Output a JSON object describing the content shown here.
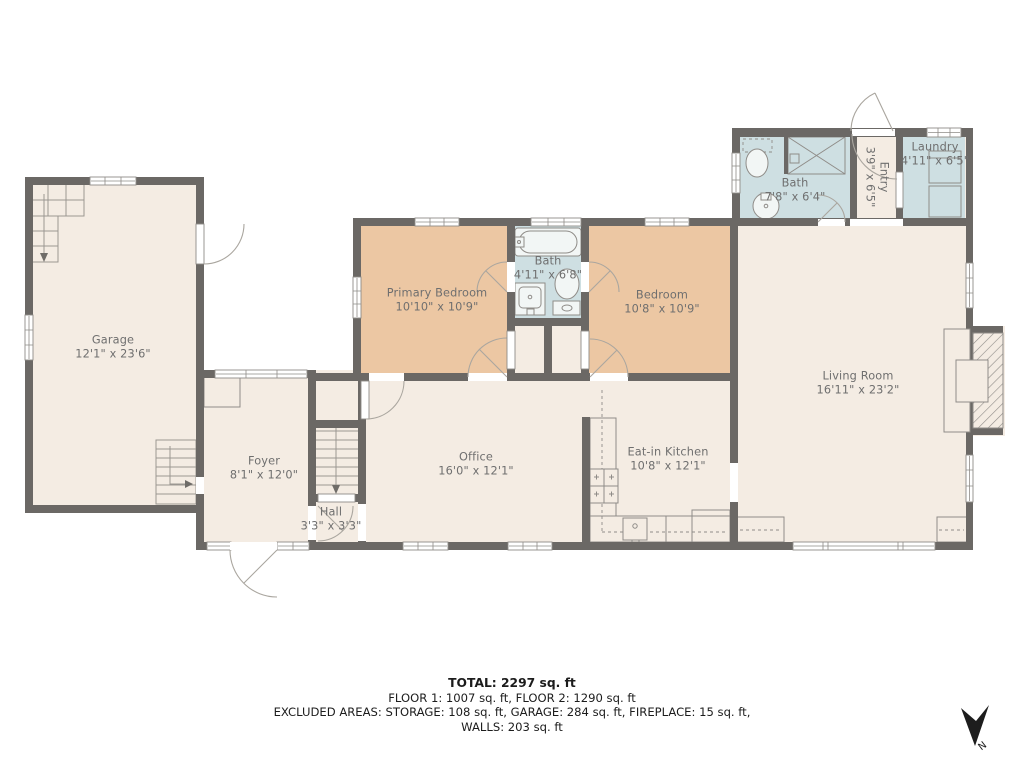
{
  "rooms": [
    {
      "id": "garage",
      "name": "Garage",
      "dims": "12'1\" x 23'6\""
    },
    {
      "id": "foyer",
      "name": "Foyer",
      "dims": "8'1\" x 12'0\""
    },
    {
      "id": "hall",
      "name": "Hall",
      "dims": "3'3\" x 3'3\""
    },
    {
      "id": "office",
      "name": "Office",
      "dims": "16'0\" x 12'1\""
    },
    {
      "id": "primary_bedroom",
      "name": "Primary Bedroom",
      "dims": "10'10\" x 10'9\""
    },
    {
      "id": "bath_main",
      "name": "Bath",
      "dims": "4'11\" x 6'8\""
    },
    {
      "id": "bedroom",
      "name": "Bedroom",
      "dims": "10'8\" x 10'9\""
    },
    {
      "id": "eat_in_kitchen",
      "name": "Eat-in Kitchen",
      "dims": "10'8\" x 12'1\""
    },
    {
      "id": "living_room",
      "name": "Living Room",
      "dims": "16'11\" x 23'2\""
    },
    {
      "id": "bath_upper",
      "name": "Bath",
      "dims": "7'8\" x 6'4\""
    },
    {
      "id": "entry",
      "name": "Entry",
      "dims": "3'9\" x 6'5\""
    },
    {
      "id": "laundry",
      "name": "Laundry",
      "dims": "4'11\" x 6'5\""
    }
  ],
  "summary": {
    "total": "TOTAL: 2297 sq. ft",
    "floors": "FLOOR 1: 1007 sq. ft, FLOOR 2: 1290 sq. ft",
    "excluded_line1": "EXCLUDED AREAS: STORAGE: 108 sq. ft, GARAGE: 284 sq. ft, FIREPLACE: 15 sq. ft,",
    "excluded_line2": "WALLS: 203 sq. ft"
  },
  "compass": {
    "label": "N"
  },
  "colors": {
    "wall": "#6b6865",
    "floor": "#f4ece3",
    "bedroom_floor": "#ecc7a3",
    "bath_floor": "#cedfe2"
  }
}
